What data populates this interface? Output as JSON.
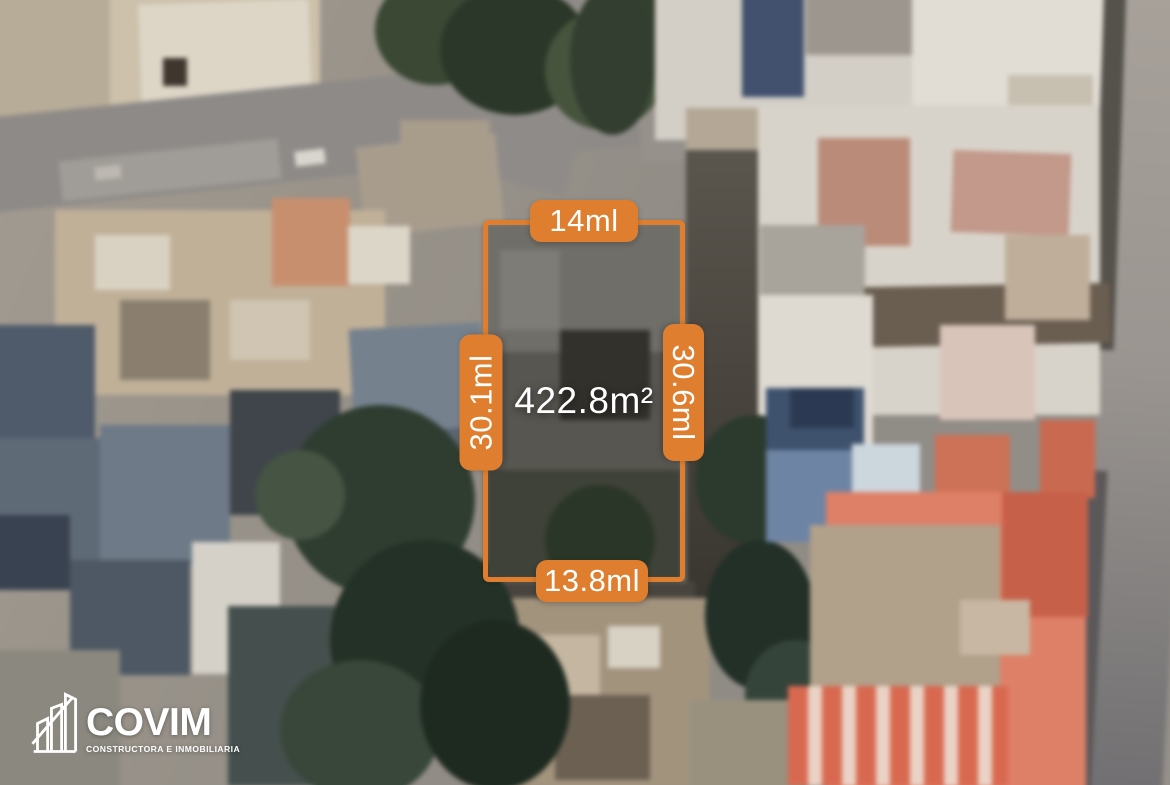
{
  "colors": {
    "accent_orange": "#DF7E2E",
    "label_text": "#FFFFFF"
  },
  "lot": {
    "side_top": "14ml",
    "side_left": "30.1ml",
    "side_right": "30.6ml",
    "side_bottom": "13.8ml",
    "area": "422.8m²"
  },
  "brand": {
    "name": "COVIM",
    "tagline": "CONSTRUCTORA E INMOBILIARIA",
    "icon": "buildings-icon"
  }
}
